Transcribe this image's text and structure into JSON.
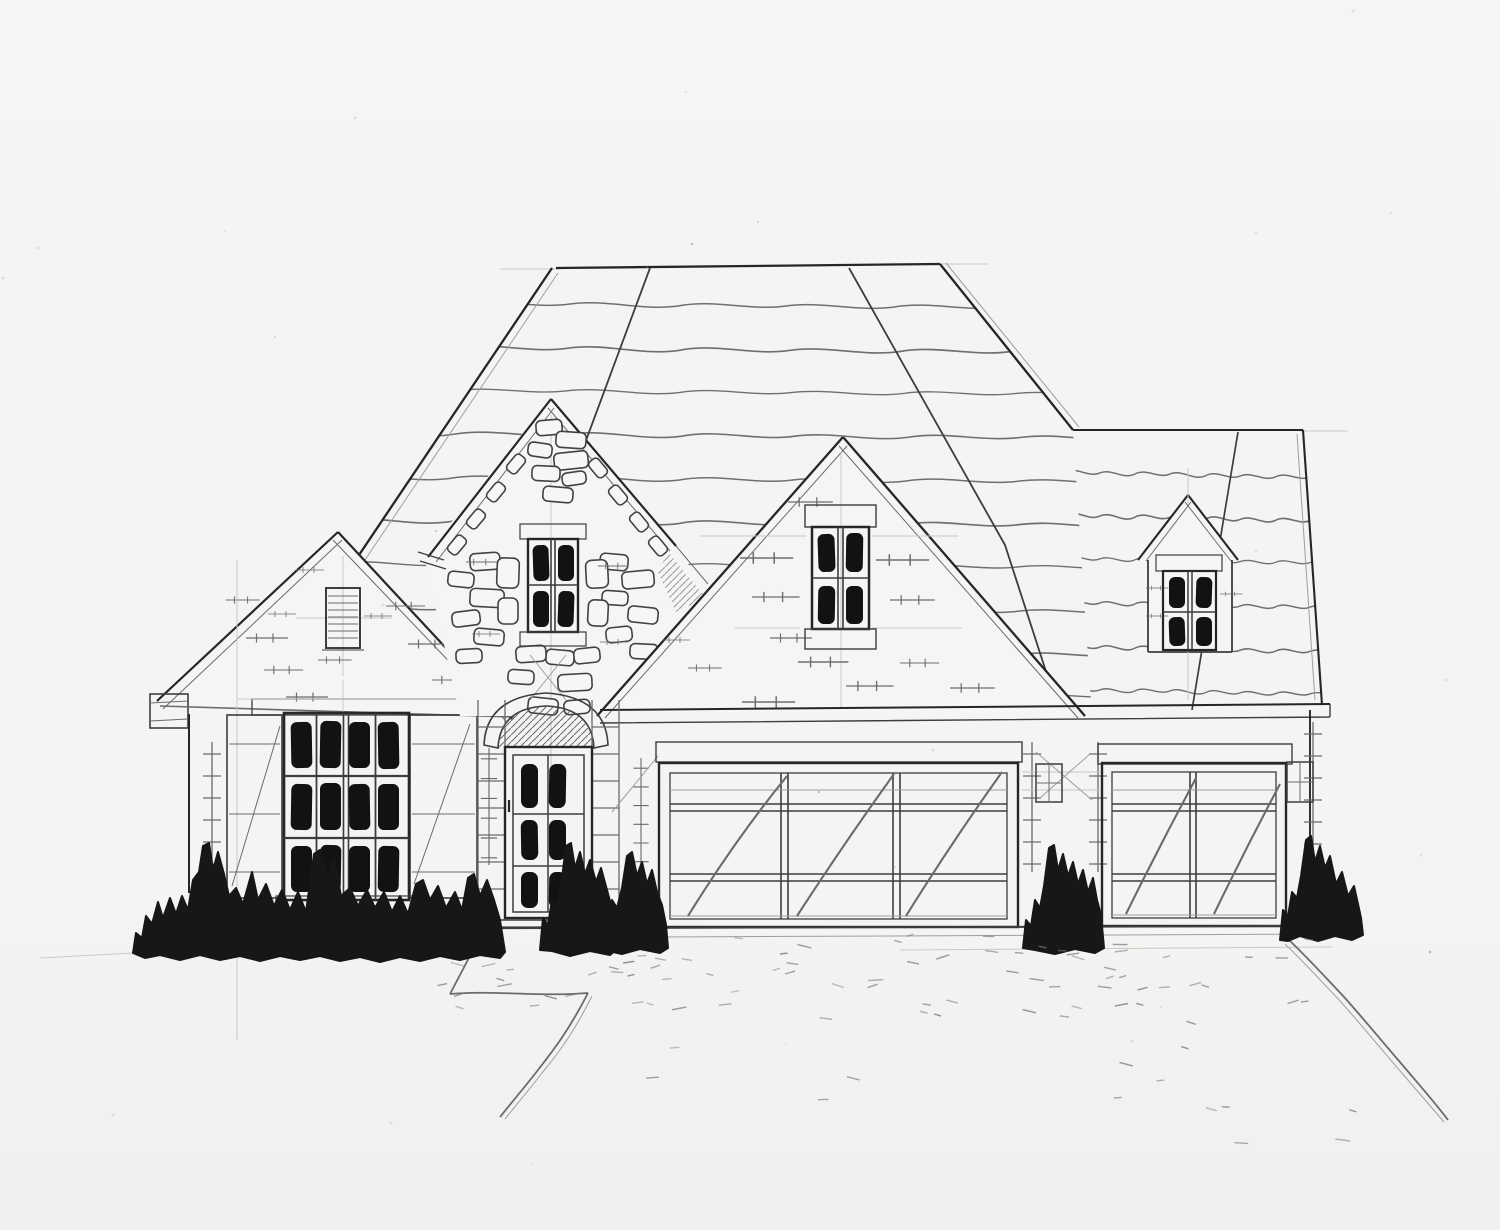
{
  "document": {
    "type": "architectural elevation sketch",
    "subject": "front elevation of a single-story brick-and-stone house",
    "medium": "pencil and black marker on paper",
    "visible_text": "none"
  },
  "palette": {
    "paper": "#f4f4f2",
    "pencil": "#3d3d3d",
    "pencil_dark": "#262626",
    "pencil_light": "#9e9e9e",
    "construction_line": "#c9c9c7",
    "glass_and_foliage": "#141414"
  },
  "scene": {
    "roofs": [
      {
        "name": "main-hip-roof",
        "texture": "wavy shingle courses with hip and seam lines"
      },
      {
        "name": "right-wing-roof",
        "texture": "wavy shingle courses"
      }
    ],
    "gables": [
      {
        "name": "left-brick-gable",
        "feature": "louvered vent"
      },
      {
        "name": "stone-entry-gable",
        "feature": "4-pane window, scattered stonework"
      },
      {
        "name": "central-brick-gable",
        "feature": "4-pane window with soldier-course header"
      },
      {
        "name": "roof-dormer",
        "feature": "4-pane window"
      }
    ],
    "windows": [
      {
        "name": "left-picture-window",
        "columns": 4,
        "rows": 3,
        "shutters": "vertical-board both sides"
      },
      {
        "name": "stone-gable-window",
        "columns": 2,
        "rows": 2
      },
      {
        "name": "central-gable-window",
        "columns": 2,
        "rows": 2
      },
      {
        "name": "dormer-window",
        "columns": 2,
        "rows": 2
      }
    ],
    "entry": {
      "door_panes": 6,
      "surround": "stone arch with hatched transom",
      "steps": 2
    },
    "garage_doors": [
      {
        "name": "double-garage-door",
        "sections": 3,
        "style": "paneled with diagonal sketch strokes"
      },
      {
        "name": "single-garage-door",
        "sections": 2,
        "style": "paneled with diagonal sketch strokes"
      }
    ],
    "landscape": {
      "hedge_rows": 1,
      "bushes": 5,
      "walkway": "angled walk at entry",
      "driveway": "stippled surface with wavy right edge"
    }
  }
}
